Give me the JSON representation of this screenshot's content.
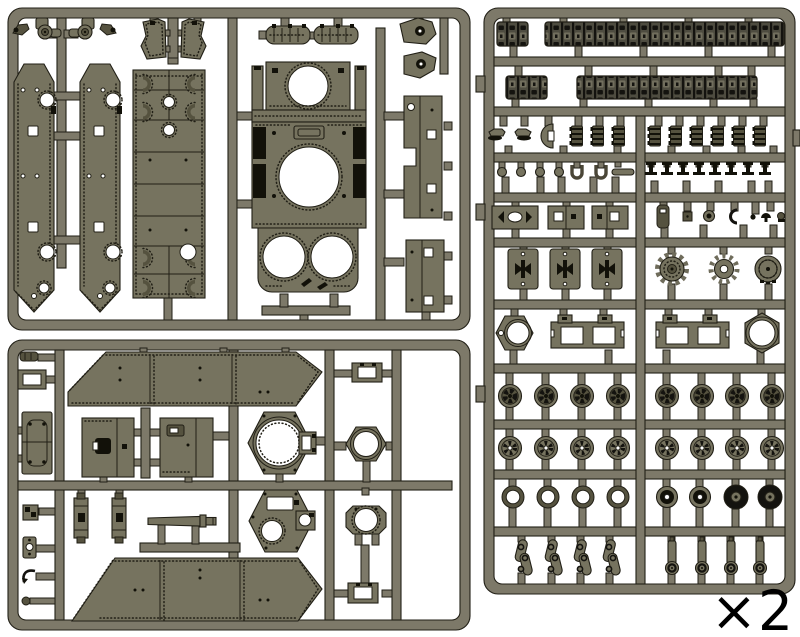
{
  "document": {
    "kind": "plastic-model-kit-sprue-diagram",
    "background": "#ffffff"
  },
  "quantity_label": {
    "text": "×2",
    "color": "#000000"
  },
  "colors": {
    "runner": "#7d7969",
    "part": "#76735f",
    "part_dark": "#55523f",
    "outline": "#211f16",
    "detail_black": "#121109",
    "background": "#ffffff"
  },
  "sprues": [
    {
      "id": "sprue-top-left",
      "contents": [
        "side-armor-plate ×2",
        "hull-roof-plate",
        "superstructure-plate-with-turret-ring",
        "side-skirt-beam ×2",
        "exhaust-muffler ×2",
        "glacis-trapezoid-plate ×2",
        "idler-mount-bracket ×2",
        "towing-wedge ×2",
        "small-wedge-fitting ×2"
      ]
    },
    {
      "id": "sprue-bottom-left",
      "contents": [
        "hull-side-plate ×2",
        "turret-ring-hexagon",
        "turret-roof-hexagon",
        "commander-cupola",
        "hex-ring-nut",
        "access-hatch-box ×2",
        "narrow-door-plate",
        "gun-barrel",
        "pillar-block ×2",
        "small-frame ×2",
        "misc-small-fittings"
      ]
    },
    {
      "id": "sprue-right",
      "contents": [
        "track-run-long ×2",
        "track-run-short ×2",
        "track-link-stack ×9",
        "tow-shackle ×2",
        "half-moon-cover",
        "small-ring ×4",
        "u-clamp ×2",
        "pin-rod",
        "detail-plate ×3",
        "t-post ×8",
        "misc-small-fittings ×7",
        "bowtie-plate ×3",
        "drive-sprocket ×2",
        "idler-drum",
        "hex-hub",
        "axle-bracket ×2",
        "hex-ring-nut",
        "road-wheel ×16",
        "wheel-ring ×4",
        "spoked-hub-wheel ×2",
        "rubber-tired-wheel ×2",
        "suspension-arm ×4",
        "swing-arm ×4"
      ]
    }
  ]
}
